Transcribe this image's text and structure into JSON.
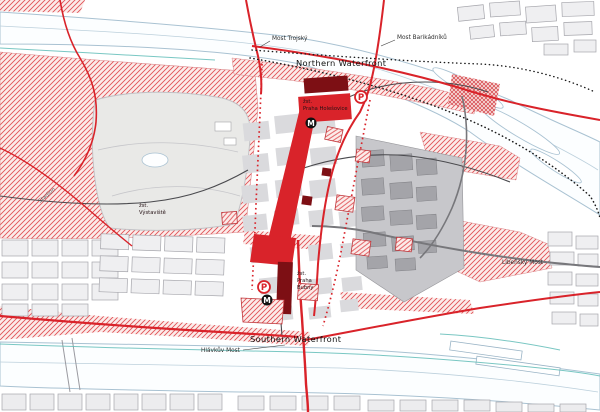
{
  "labels": {
    "northern_waterfront": "Northern Waterfront",
    "southern_waterfront": "Southern Waterfront",
    "most_trojsky": "Most Trojský",
    "most_barikadniku": "Most Barikádníků",
    "hlavkuv_most": "Hlávkův Most",
    "libensky_most": "Libeňský Most",
    "stadion": "Stadion",
    "station_holesovice": {
      "l1": "žst.",
      "l2": "Praha Holešovice"
    },
    "station_bubny": {
      "l1": "žst.",
      "l2": "Praha",
      "l3": "Bubny"
    },
    "station_vystaviste": {
      "l1": "žst.",
      "l2": "Výstaviště"
    }
  },
  "icons": {
    "metro": "M",
    "parking": "P"
  },
  "colors": {
    "accent_red": "#d9232a",
    "dark_red": "#7d0f14",
    "hatch_line_red": "#e05257",
    "river_outline_blue": "#a9c2d2",
    "teal_path": "#62bdb8",
    "proposed_block_gray": "#dadadd",
    "existing_block_gray": "#a4a4a9",
    "metro_black": "#111111"
  }
}
